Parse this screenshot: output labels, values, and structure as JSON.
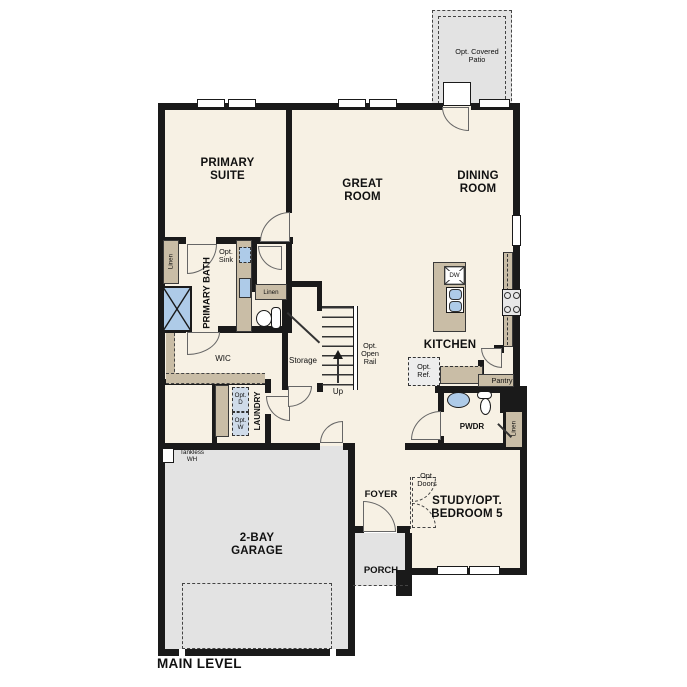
{
  "title": "MAIN LEVEL",
  "colors": {
    "wall": "#1a1a1a",
    "floor": "#f7f1e4",
    "surface_gray": "#e3e3e3",
    "cabinet_tan": "#c9bda6",
    "fixture_blue": "#aecbe8"
  },
  "rooms": {
    "patio": "Opt. Covered Patio",
    "primary_suite": "PRIMARY SUITE",
    "great_room": "GREAT ROOM",
    "dining_room": "DINING ROOM",
    "kitchen": "KITCHEN",
    "primary_bath": "PRIMARY BATH",
    "wic": "WIC",
    "storage": "Storage",
    "laundry": "LAUNDRY",
    "powder": "PWDR",
    "pantry": "Pantry",
    "foyer": "FOYER",
    "study": "STUDY/OPT. BEDROOM 5",
    "garage": "2-BAY GARAGE",
    "porch": "PORCH"
  },
  "annotations": {
    "linen_left": "Linen",
    "linen_hall": "Linen",
    "linen_powder": "Linen",
    "opt_sink": "Opt. Sink",
    "opt_ref": "Opt. Ref.",
    "opt_dryer": "Opt. D",
    "opt_washer": "Opt. W",
    "opt_doors": "Opt. Doors",
    "opt_open_rail": "Opt. Open Rail",
    "up": "Up",
    "tankless": "Tankless WH",
    "dishwasher": "DW"
  }
}
